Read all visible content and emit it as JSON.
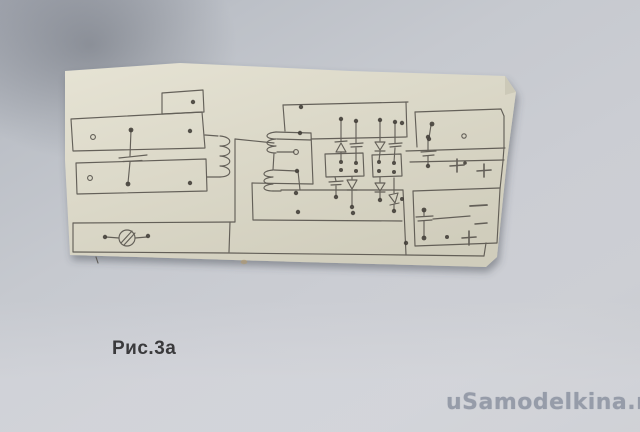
{
  "image": {
    "kind": "photo of hand-drawn pencil circuit schematic on paper scrap",
    "width": 640,
    "height": 432
  },
  "caption": {
    "text": "Рис.3а"
  },
  "watermark": {
    "text": "uSamodelkina.ru"
  },
  "colors": {
    "background_gray": "#c6c9cf",
    "background_dark_corner": "#a7abb4",
    "paper_light": "#e4e1d2",
    "paper_dark": "#d2cfbe",
    "pencil": "#54504a",
    "caption_text": "#3a3a3c",
    "watermark_text": "#939aa7",
    "stain": "#b09a6f"
  },
  "schematic": {
    "description": "pencil-sketched power-supply wiring layout",
    "components": [
      "small-terminal-box",
      "upper-terminal-strip",
      "lower-terminal-strip",
      "capacitor",
      "primary-winding-coil",
      "fuse-lamp-symbol",
      "bottom-bus-bar",
      "secondary-winding-coils",
      "diode-capacitor-rectifier-pairs",
      "middle-terminal-boxes",
      "output-block-upper",
      "output-block-lower"
    ],
    "polarity_marks": {
      "plus": [
        "+",
        "+",
        "+"
      ],
      "minus": [
        "−"
      ]
    }
  }
}
